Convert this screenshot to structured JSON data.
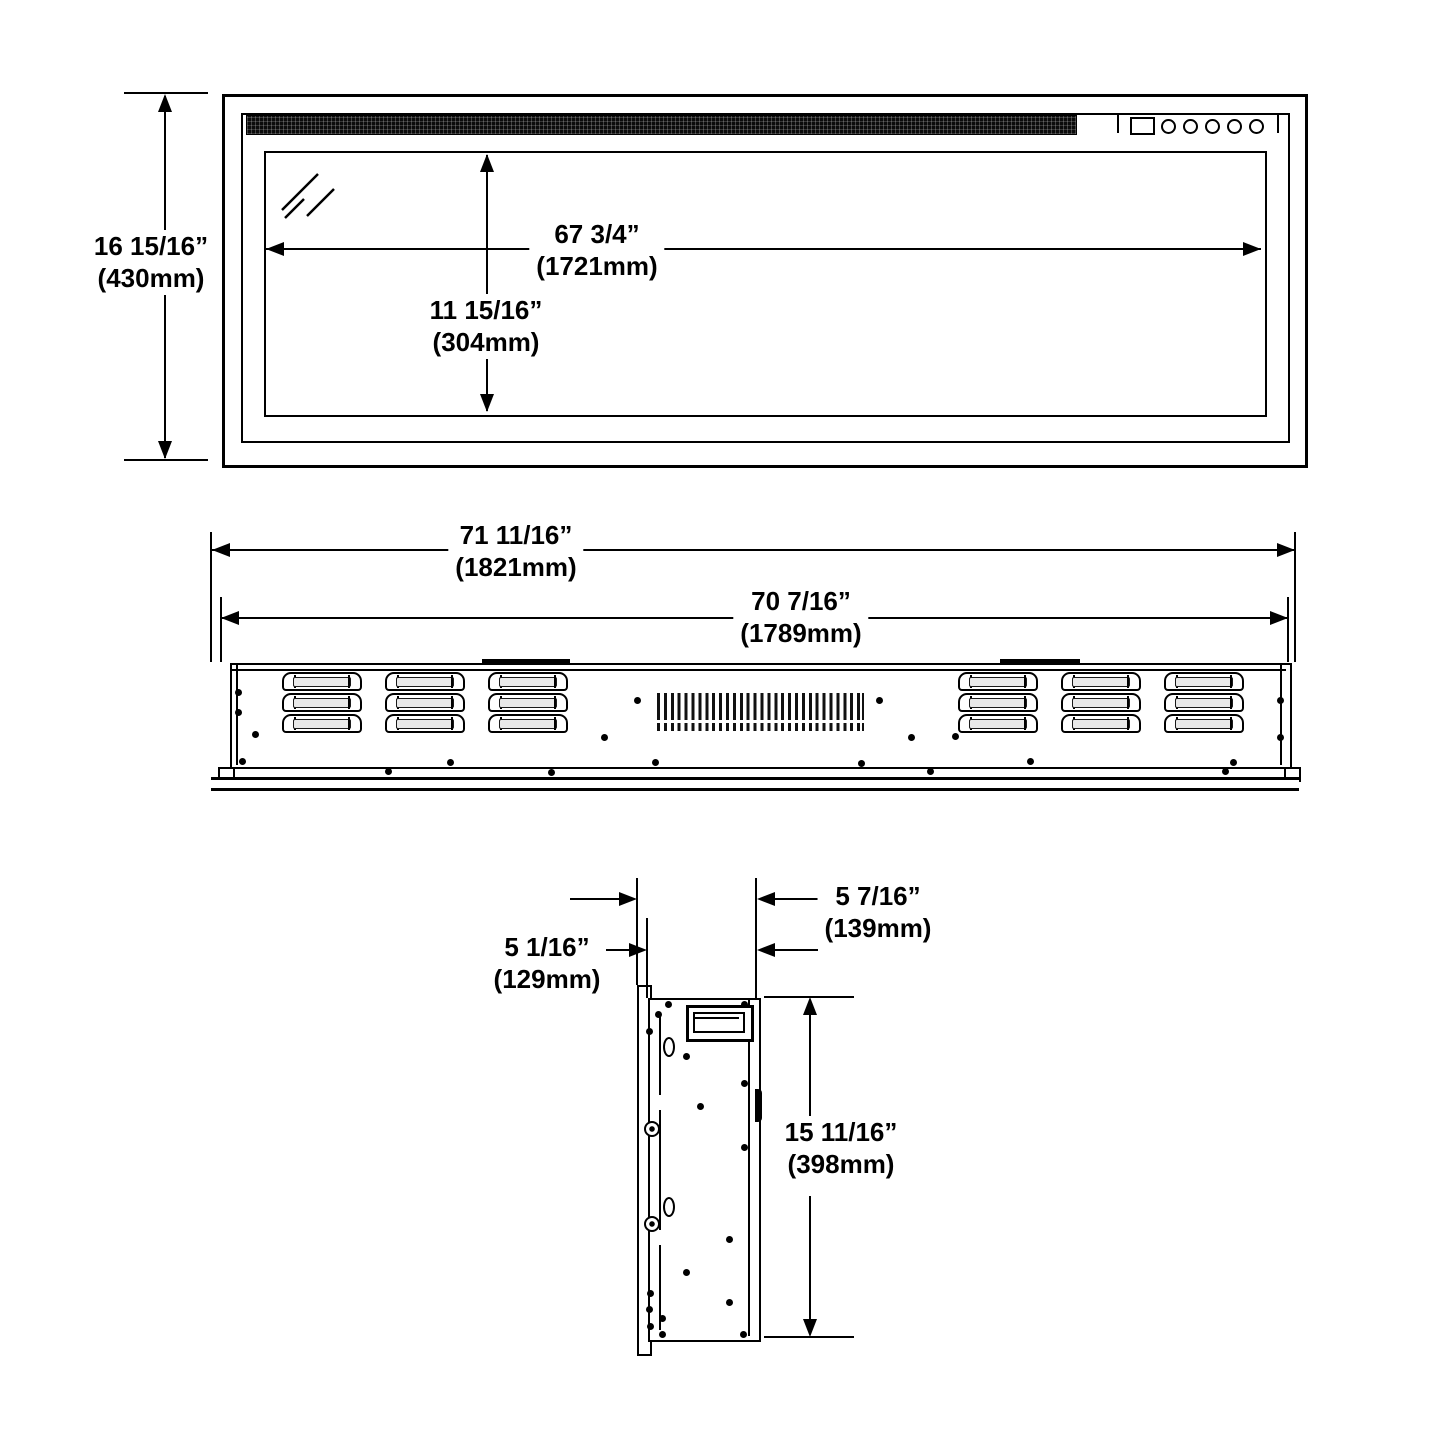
{
  "dims": {
    "front_height_in": "16 15/16”",
    "front_height_mm": "(430mm)",
    "glass_width_in": "67 3/4”",
    "glass_width_mm": "(1721mm)",
    "glass_height_in": "11 15/16”",
    "glass_height_mm": "(304mm)",
    "rear_overall_in": "71 11/16”",
    "rear_overall_mm": "(1821mm)",
    "rear_body_in": "70 7/16”",
    "rear_body_mm": "(1789mm)",
    "side_depth_overall_in": "5 7/16”",
    "side_depth_overall_mm": "(139mm)",
    "side_depth_body_in": "5 1/16”",
    "side_depth_body_mm": "(129mm)",
    "side_height_in": "15 11/16”",
    "side_height_mm": "(398mm)"
  },
  "colors": {
    "line": "#000000",
    "louver_fill": "#e9e9e9",
    "mesh": "#0b0b0b",
    "background": "#ffffff"
  },
  "icons": {
    "reflection": "glass-reflection-marks",
    "buttons": "control-button-row"
  },
  "decor": {
    "louver_cols": [
      282,
      385,
      488,
      958,
      1061,
      1164
    ],
    "louver_rows": [
      672,
      693,
      714
    ],
    "louver_w": 76,
    "louver_h": 15,
    "rear_dots": [
      [
        238,
        692
      ],
      [
        238,
        712
      ],
      [
        255,
        734
      ],
      [
        242,
        761
      ],
      [
        450,
        762
      ],
      [
        604,
        737
      ],
      [
        637,
        700
      ],
      [
        655,
        762
      ],
      [
        879,
        700
      ],
      [
        911,
        737
      ],
      [
        955,
        736
      ],
      [
        861,
        763
      ],
      [
        1030,
        761
      ],
      [
        1233,
        762
      ],
      [
        1280,
        700
      ],
      [
        1280,
        737
      ],
      [
        388,
        771
      ],
      [
        551,
        772
      ],
      [
        930,
        771
      ],
      [
        1225,
        771
      ]
    ],
    "side_dots": [
      [
        668,
        1004
      ],
      [
        744,
        1004
      ],
      [
        658,
        1014
      ],
      [
        649,
        1031
      ],
      [
        686,
        1056
      ],
      [
        744,
        1083
      ],
      [
        700,
        1106
      ],
      [
        744,
        1147
      ],
      [
        729,
        1239
      ],
      [
        686,
        1272
      ],
      [
        729,
        1302
      ],
      [
        662,
        1318
      ],
      [
        650,
        1293
      ],
      [
        649,
        1309
      ],
      [
        650,
        1326
      ],
      [
        743,
        1334
      ],
      [
        662,
        1334
      ]
    ],
    "side_screws": [
      [
        650,
        1127
      ],
      [
        650,
        1222
      ]
    ],
    "side_ovals": [
      [
        667,
        1045
      ],
      [
        667,
        1205
      ]
    ]
  }
}
